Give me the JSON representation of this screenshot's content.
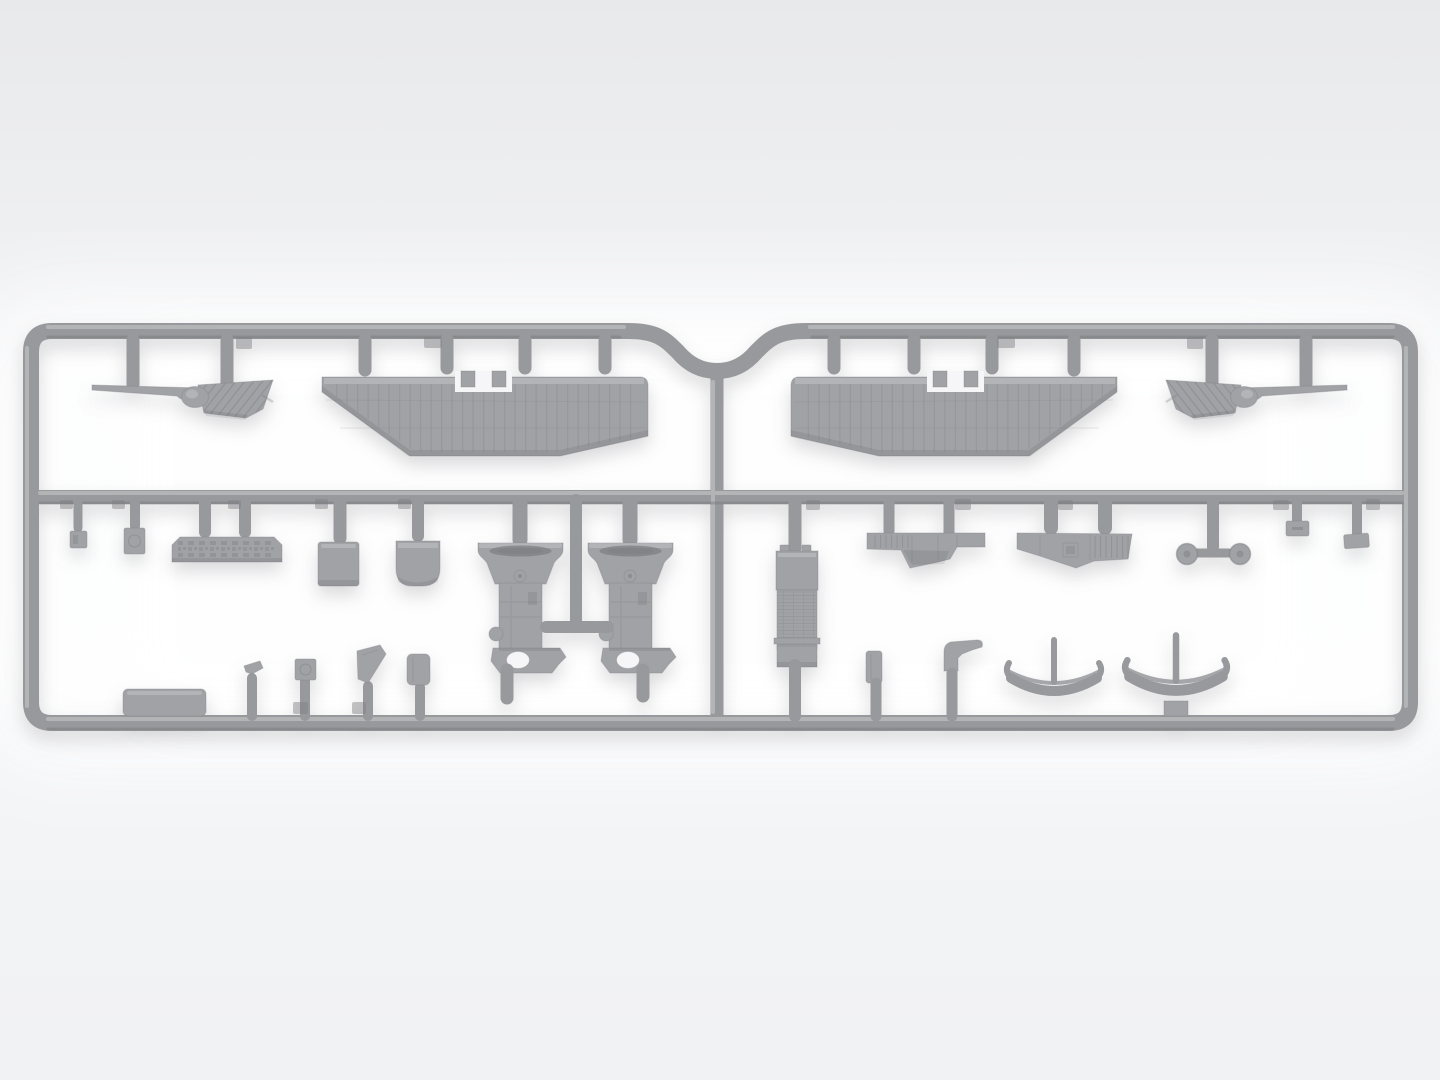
{
  "scene": {
    "subject": "injection-molded model aircraft sprue of light gray polystyrene",
    "style": "3D product render on a pale gray studio background with soft white glow behind the runner",
    "frame": "rectangular two-row runner frame, mirrored left/right halves, U-shaped dip at top center with a vertical feed runner"
  },
  "colors": {
    "background-top": "#e8e9eb",
    "background-mid": "#f1f2f4",
    "background-low": "#f3f4f6",
    "glow": "#ffffff",
    "plastic-base": "#98999c",
    "plastic-part": "#a1a2a5",
    "plastic-dark": "#7e7f83",
    "edge-hi": "#b9babd",
    "edge-lo": "#77787c",
    "rib": "#88898c",
    "hole": "#f6f6f8",
    "shadow": "rgba(70,72,82,0.20)"
  },
  "parts": [
    {
      "name": "stabilizer-with-elevator",
      "count": 2,
      "location": "top row outer, mirrored pair"
    },
    {
      "name": "lower-wing-panel",
      "count": 2,
      "location": "top row center, mirrored pair, ribbed with center notch"
    },
    {
      "name": "instrument-panel",
      "count": 1,
      "location": "bottom-left row"
    },
    {
      "name": "small-hatch-plate",
      "count": 2,
      "location": "bottom-left row"
    },
    {
      "name": "bulkhead-plate",
      "count": 1,
      "location": "bottom-left row"
    },
    {
      "name": "seat-plate",
      "count": 1,
      "location": "bottom-left row"
    },
    {
      "name": "engine-bearer-half",
      "count": 2,
      "location": "bottom-left center, joined by T-runner, bell top and pierced foot"
    },
    {
      "name": "radiator-block",
      "count": 1,
      "location": "bottom-right row, textured"
    },
    {
      "name": "upper-wing-centre-section",
      "count": 2,
      "location": "bottom-right row, partially ribbed"
    },
    {
      "name": "landing-ski",
      "count": 2,
      "location": "bottom-right row, curved runners with posts"
    },
    {
      "name": "wheel",
      "count": 2,
      "location": "bottom-right row with T-axle runner"
    },
    {
      "name": "small-fitting",
      "count": 10,
      "location": "various, on short gates along rails"
    }
  ]
}
